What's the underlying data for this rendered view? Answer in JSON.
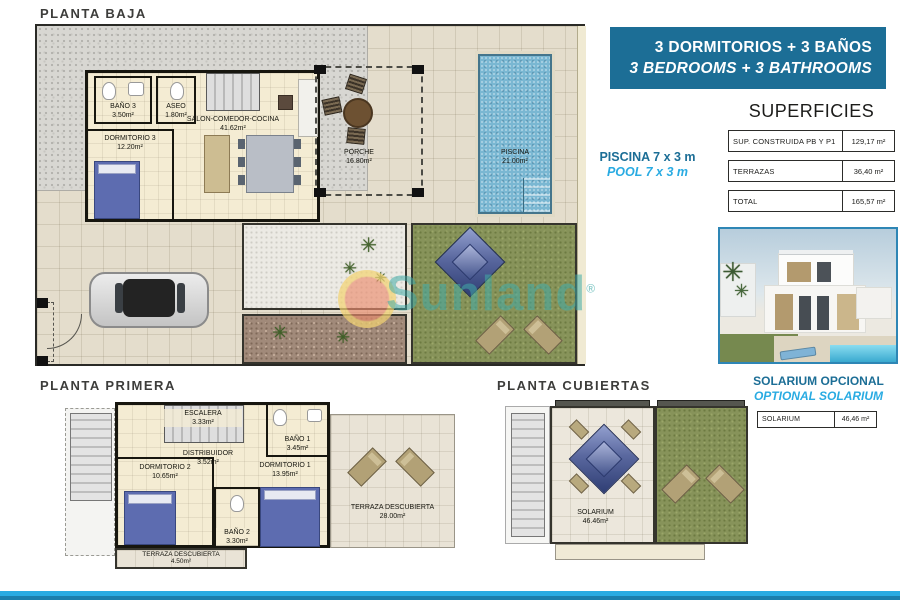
{
  "accent": {
    "dark_blue": "#1c6e96",
    "light_blue": "#29abe2"
  },
  "watermark": {
    "text": "Sunland",
    "reg": "®"
  },
  "banner": {
    "line1": "3 DORMITORIOS + 3 BAÑOS",
    "line2": "3 BEDROOMS + 3 BATHROOMS"
  },
  "superficies": {
    "title": "SUPERFICIES",
    "rows": [
      {
        "label": "SUP. CONSTRUIDA PB Y P1",
        "value": "129,17 m²"
      },
      {
        "label": "TERRAZAS",
        "value": "36,40 m²"
      },
      {
        "label": "TOTAL",
        "value": "165,57 m²"
      }
    ]
  },
  "pool_note": {
    "es": "PISCINA 7 x 3 m",
    "en": "POOL 7 x 3 m"
  },
  "solarium_note": {
    "es": "SOLARIUM OPCIONAL",
    "en": "OPTIONAL SOLARIUM",
    "label": "SOLARIUM",
    "value": "46,46 m²"
  },
  "planta_baja": {
    "title": "PLANTA BAJA",
    "rooms": {
      "bano3": {
        "name": "BAÑO 3",
        "area": "3.50m²"
      },
      "aseo": {
        "name": "ASEO",
        "area": "1.80m²"
      },
      "salon": {
        "name": "SALON-COMEDOR-COCINA",
        "area": "41.62m²"
      },
      "dorm3": {
        "name": "DORMITORIO 3",
        "area": "12.20m²"
      },
      "porche": {
        "name": "PORCHE",
        "area": "16.80m²"
      },
      "piscina": {
        "name": "PISCINA",
        "area": "21.00m²"
      }
    }
  },
  "planta_primera": {
    "title": "PLANTA PRIMERA",
    "rooms": {
      "escalera": {
        "name": "ESCALERA",
        "area": "3.33m²"
      },
      "distribuidor": {
        "name": "DISTRIBUIDOR",
        "area": "3.52m²"
      },
      "bano1": {
        "name": "BAÑO 1",
        "area": "3.45m²"
      },
      "dorm2": {
        "name": "DORMITORIO 2",
        "area": "10.65m²"
      },
      "dorm1": {
        "name": "DORMITORIO 1",
        "area": "13.95m²"
      },
      "bano2": {
        "name": "BAÑO 2",
        "area": "3.30m²"
      },
      "terraza_grande": {
        "name": "TERRAZA DESCUBIERTA",
        "area": "28.00m²"
      },
      "terraza_chica": {
        "name": "TERRAZA DESCUBIERTA",
        "area": "4.50m²"
      }
    }
  },
  "planta_cubiertas": {
    "title": "PLANTA CUBIERTAS",
    "rooms": {
      "solarium": {
        "name": "SOLARIUM",
        "area": "46.46m²"
      }
    }
  }
}
